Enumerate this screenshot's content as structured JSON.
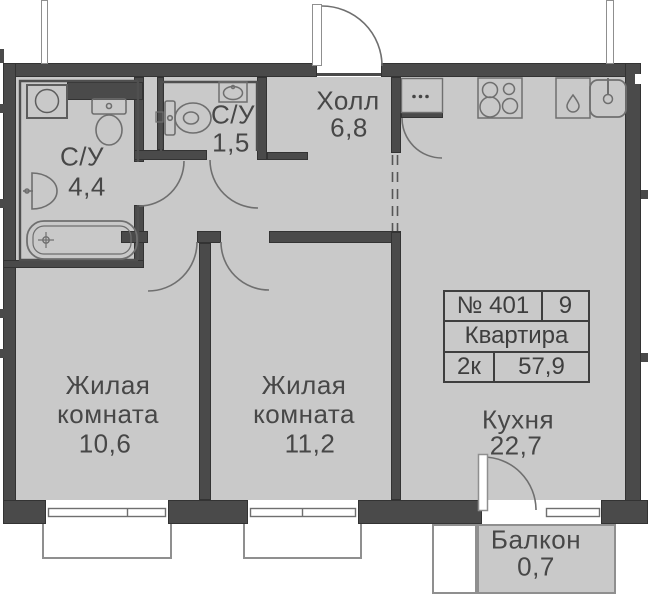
{
  "title": "План квартиры",
  "colors": {
    "floor_fill": "#c9c9c9",
    "wall": "#4a4a4a",
    "thin_line": "#6f6f6f",
    "text": "#474747"
  },
  "rooms": {
    "bathroom_large": {
      "name": "С/У",
      "area": "4,4"
    },
    "bathroom_small": {
      "name": "С/У",
      "area": "1,5"
    },
    "hall": {
      "name": "Холл",
      "area": "6,8"
    },
    "living_room_1": {
      "name": "Жилая комната",
      "area": "10,6"
    },
    "living_room_2": {
      "name": "Жилая комната",
      "area": "11,2"
    },
    "kitchen": {
      "name": "Кухня",
      "area": "22,7"
    },
    "balcony": {
      "name": "Балкон",
      "area": "0,7"
    }
  },
  "info_table": {
    "unit_number": "№ 401",
    "floor": "9",
    "type": "Квартира",
    "layout": "2к",
    "total_area": "57,9"
  },
  "fixtures": [
    "washing-machine",
    "toilet",
    "washbasin",
    "bathtub",
    "compact-toilet",
    "small-washbasin",
    "wardrobe",
    "stove-4-burner",
    "dishwasher",
    "kitchen-sink",
    "entrance-door",
    "interior-door",
    "balcony-door",
    "window"
  ]
}
